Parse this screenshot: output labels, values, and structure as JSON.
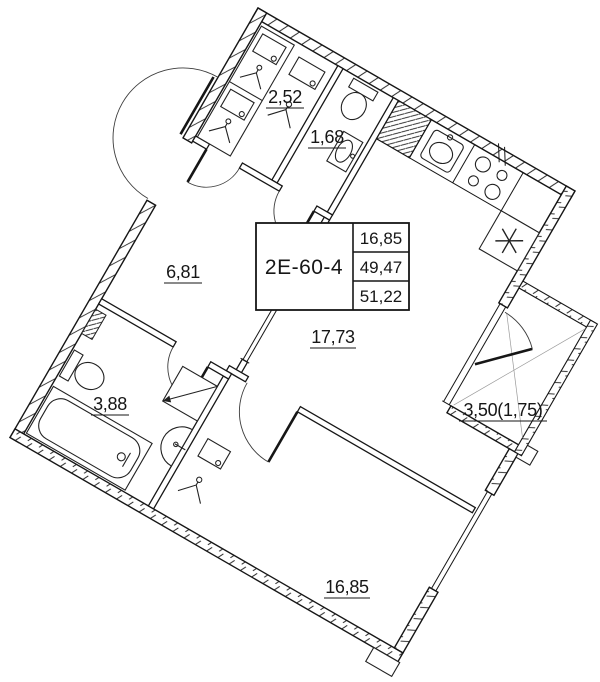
{
  "plan": {
    "unit_code": "2E-60-4",
    "summary": {
      "living_area": "16,85",
      "apartment_area": "49,47",
      "total_area": "51,22"
    },
    "rooms": {
      "closet": "2,52",
      "wc": "1,68",
      "hallway": "6,81",
      "kitchen_living": "17,73",
      "bathroom": "3,88",
      "bedroom": "16,85",
      "balcony": "3,50(1,75)"
    },
    "colors": {
      "line": "#161616",
      "background": "#ffffff"
    },
    "icons": [
      "hanger-icon",
      "shelf-box-icon",
      "toilet-icon",
      "washbasin-icon",
      "bathtub-icon",
      "stove-icon",
      "fridge-icon",
      "washing-machine-icon",
      "radiator-icon",
      "kitchen-sink-icon",
      "door-arc-icon",
      "window-icon"
    ]
  }
}
